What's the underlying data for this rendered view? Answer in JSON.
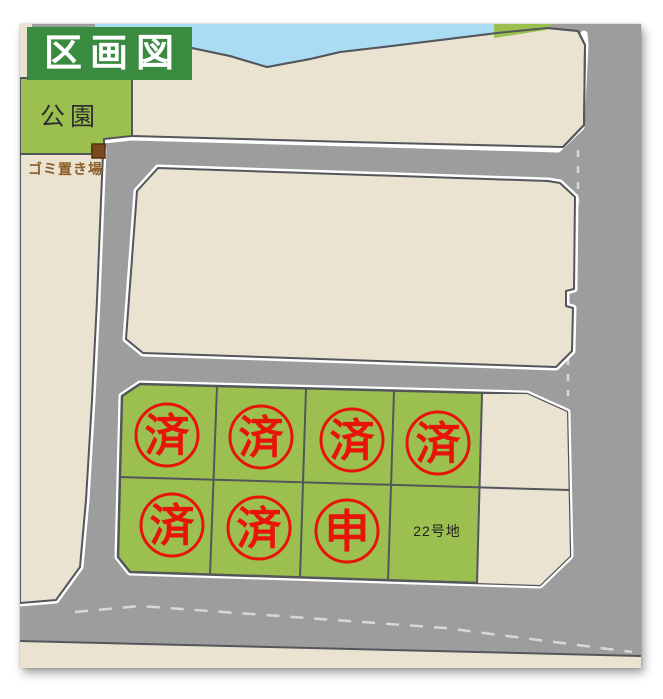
{
  "header": {
    "title": "区画図"
  },
  "map": {
    "park": {
      "label": "公園"
    },
    "garbage_area": {
      "label": "ゴミ置き場"
    },
    "water": {
      "name": "river"
    },
    "lots": [
      {
        "row": 1,
        "col": 1,
        "stamp": "済"
      },
      {
        "row": 1,
        "col": 2,
        "stamp": "済"
      },
      {
        "row": 1,
        "col": 3,
        "stamp": "済"
      },
      {
        "row": 1,
        "col": 4,
        "stamp": "済"
      },
      {
        "row": 2,
        "col": 1,
        "stamp": "済"
      },
      {
        "row": 2,
        "col": 2,
        "stamp": "済"
      },
      {
        "row": 2,
        "col": 3,
        "stamp": "申"
      },
      {
        "row": 2,
        "col": 4,
        "label": "22号地"
      }
    ]
  },
  "colors": {
    "road_gray": "#9d9d9d",
    "parcel_beige": "#eae3d1",
    "lot_green": "#9cc050",
    "title_green": "#3a8a3f",
    "water_blue": "#aadcf3",
    "boundary_dark": "#53565a",
    "stamp_red": "#e8140a",
    "garbage_brown": "#7a4a1e",
    "garbage_text_brown": "#8a5c28"
  }
}
